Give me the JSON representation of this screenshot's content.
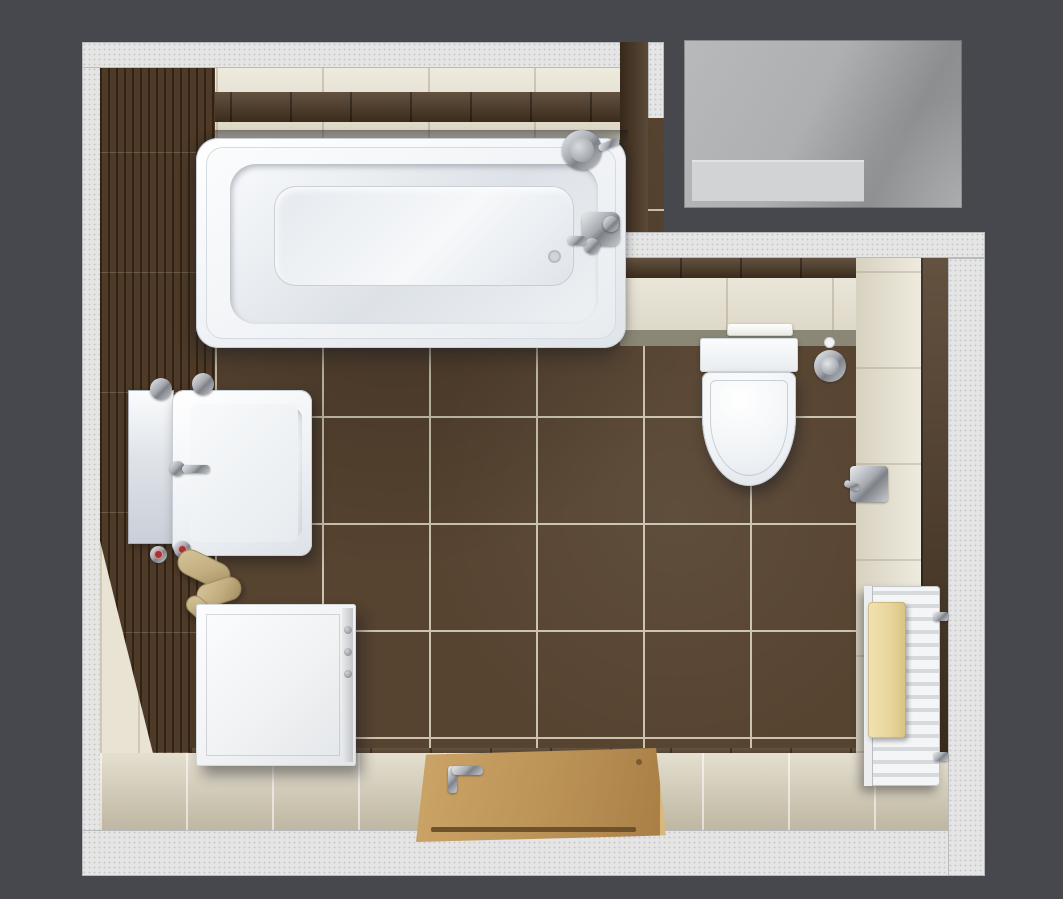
{
  "scene": {
    "type": "3d-render-top-view",
    "room": "bathroom",
    "view": "top-down floor plan render",
    "objects": [
      {
        "name": "bathtub",
        "label": "Bathtub"
      },
      {
        "name": "shower-head",
        "label": "Shower head"
      },
      {
        "name": "bath-mixer-tap",
        "label": "Bath mixer tap"
      },
      {
        "name": "washbasin",
        "label": "Washbasin"
      },
      {
        "name": "sink-tap",
        "label": "Sink tap"
      },
      {
        "name": "mirror",
        "label": "Mirror"
      },
      {
        "name": "wall-tumblers",
        "label": "Wall tumblers"
      },
      {
        "name": "angle-valves",
        "label": "Angle valves"
      },
      {
        "name": "drain-trap",
        "label": "Drain trap"
      },
      {
        "name": "washing-machine",
        "label": "Washing machine"
      },
      {
        "name": "toilet",
        "label": "Wall-hung toilet"
      },
      {
        "name": "flush-plate",
        "label": "Flush plate"
      },
      {
        "name": "toilet-roll-holder",
        "label": "Toilet roll holder"
      },
      {
        "name": "wall-bracket",
        "label": "Wall bracket"
      },
      {
        "name": "towel-radiator",
        "label": "Towel radiator"
      },
      {
        "name": "towel",
        "label": "Towel"
      },
      {
        "name": "door",
        "label": "Open wooden door"
      },
      {
        "name": "door-handle",
        "label": "Door handle"
      },
      {
        "name": "niche-opening",
        "label": "Adjacent niche"
      }
    ]
  },
  "palette": {
    "background": "#46484e",
    "outer_wall": "#e4e5e4",
    "wall_cream": "#e8e3d3",
    "accent_brown": "#4e3a26",
    "floor_brown": "#564330",
    "floor_grout": "#cbc3ae",
    "floor_beige": "#d9d1bb",
    "olive_shadow": "#8b8776",
    "fixture_white": "#f5f7f9",
    "chrome_light": "#e9ebed",
    "chrome_dark": "#7e8288",
    "wood": "#bd9458",
    "wood_dark": "#6e522c",
    "towel_yellow": "#e9d69e",
    "valve_red": "#a83232",
    "pipe_tan": "#c2ad80",
    "niche_light": "#b8b9bb",
    "niche_mid": "#9a9b9d",
    "niche_band": "#d2d3d5"
  }
}
